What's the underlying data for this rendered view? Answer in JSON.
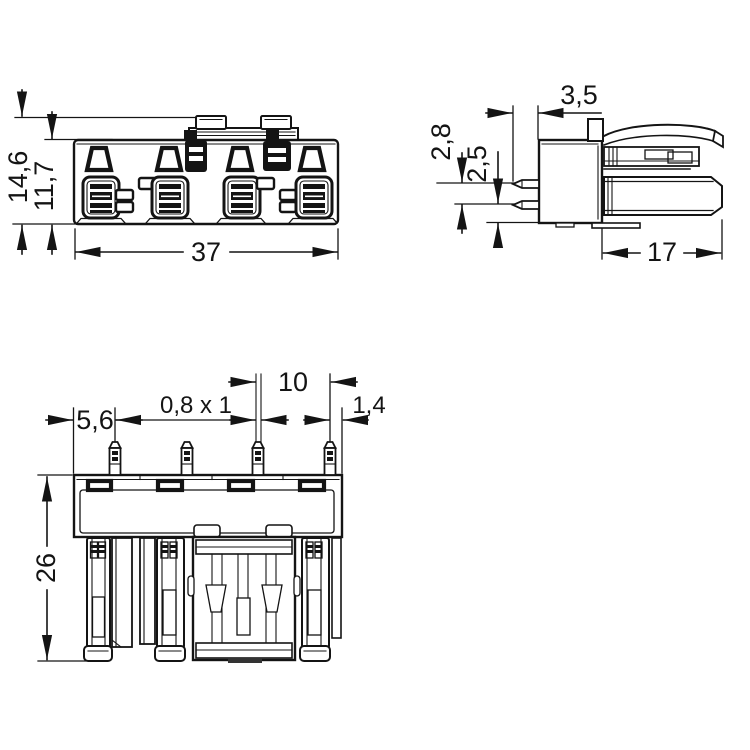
{
  "page": {
    "background": "#ffffff",
    "line_color": "#141414"
  },
  "dimensions": {
    "front": {
      "total_height": "14,6",
      "body_height": "11,7",
      "width": "37"
    },
    "side": {
      "pin_protrusion": "3,5",
      "pin_row_spacing": "2,8",
      "pin_row_to_bottom": "2,5",
      "depth": "17"
    },
    "bottom": {
      "edge_to_first_pin": "5,6",
      "pin_cross_section": "0,8 x 1",
      "pin_pitch": "10",
      "last_pin_to_edge": "1,4",
      "total_length": "26"
    }
  }
}
